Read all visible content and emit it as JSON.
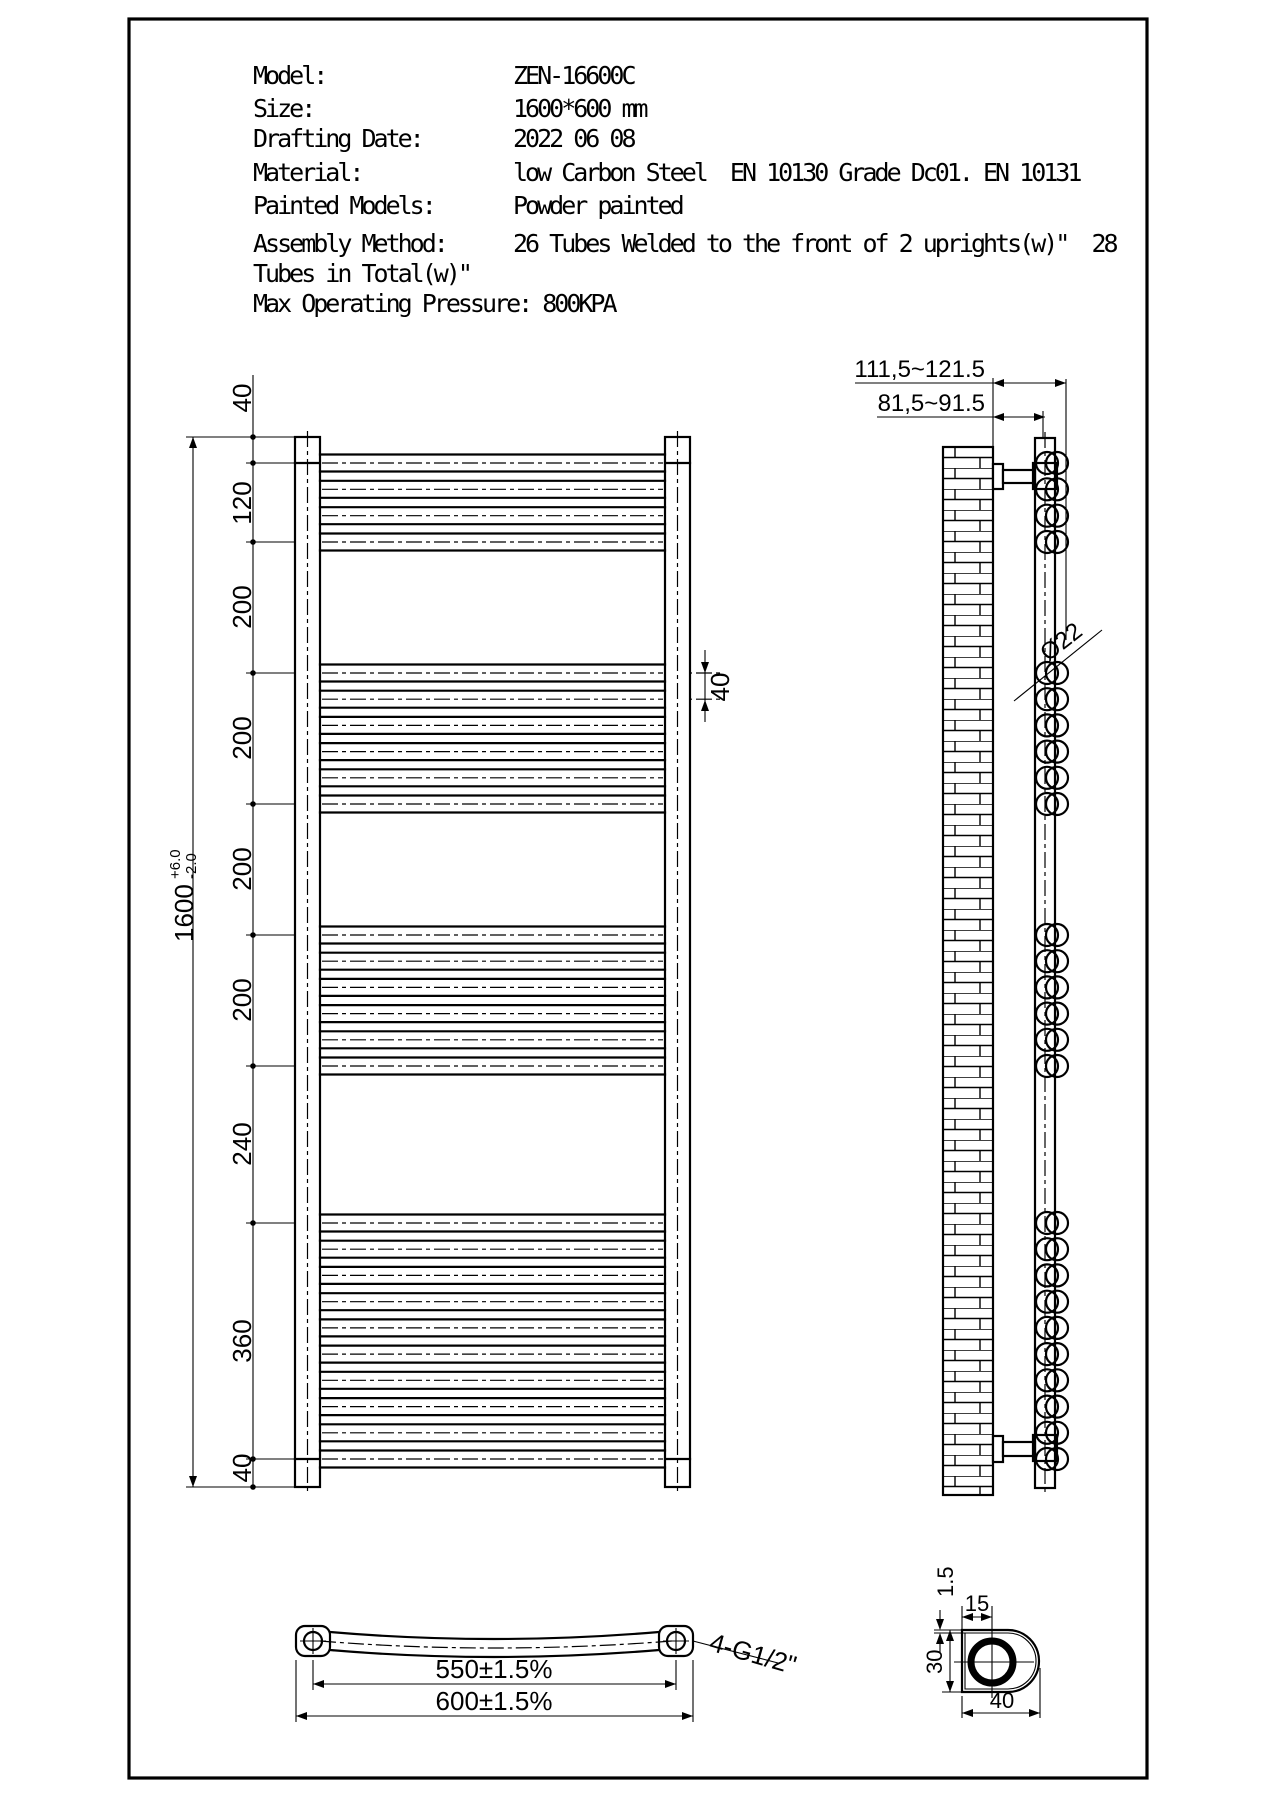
{
  "specs": {
    "rows": [
      {
        "label": "Model:",
        "value": "ZEN-16600C"
      },
      {
        "label": "Size:",
        "value": "1600*600 mm"
      },
      {
        "label": "Drafting Date:",
        "value": "2022 06 08"
      },
      {
        "label": "Material:",
        "value": "low Carbon Steel  EN 10130 Grade Dc01. EN 10131"
      },
      {
        "label": "Painted Models:",
        "value": "Powder painted"
      },
      {
        "label": "Assembly Method:",
        "value": "26 Tubes Welded to the front of 2 uprights(w)\"  28"
      },
      {
        "label": "Tubes in Total(w)\"",
        "value": ""
      },
      {
        "label": "Max Operating Pressure: 800KPA",
        "value": ""
      }
    ]
  },
  "front_view": {
    "height_dim": {
      "value": "1600",
      "tol_plus": "+6.0",
      "tol_minus": "-2.0"
    },
    "pitch_label": "40",
    "chain_labels": [
      {
        "text": "40",
        "y": 398
      },
      {
        "text": "120",
        "y": 503
      },
      {
        "text": "200",
        "y": 607
      },
      {
        "text": "200",
        "y": 738
      },
      {
        "text": "200",
        "y": 869
      },
      {
        "text": "200",
        "y": 1000
      },
      {
        "text": "240",
        "y": 1144
      },
      {
        "text": "360",
        "y": 1341
      },
      {
        "text": "40",
        "y": 1468
      }
    ],
    "boundaries": [
      437,
      463,
      542,
      673,
      804,
      935,
      1066,
      1223,
      1459,
      1487
    ],
    "tube_groups": [
      {
        "start": 463,
        "end": 542,
        "count": 4
      },
      {
        "start": 673,
        "end": 804,
        "count": 6
      },
      {
        "start": 935,
        "end": 1066,
        "count": 6
      },
      {
        "start": 1223,
        "end": 1459,
        "count": 10
      }
    ]
  },
  "side_view": {
    "dim_outer": "111,5~121.5",
    "dim_inner": "81,5~91.5",
    "tube_dia": "Ø22"
  },
  "bottom_view": {
    "dim_centers": "550±1.5%",
    "dim_overall": "600±1.5%",
    "fitting": "4-G1/2\""
  },
  "detail_view": {
    "wall": "1.5",
    "offset": "15",
    "height": "30",
    "width": "40"
  }
}
